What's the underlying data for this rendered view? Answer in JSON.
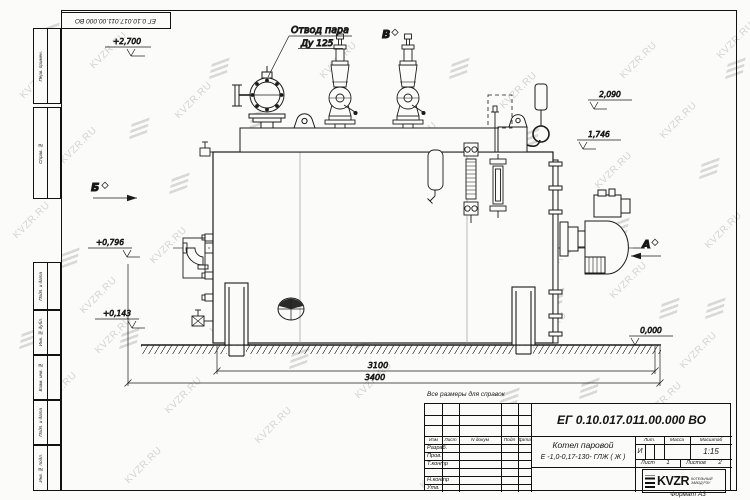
{
  "watermark": {
    "text": "KVZR.RU"
  },
  "frame": {
    "stamp": "ЕГ 0.10.017.011.00.000  ВО",
    "left_cells": [
      "Перв. примен.",
      "Справ. №",
      "Подп. и дата",
      "Инв. № дубл.",
      "Взам. инв. №",
      "Подп. и дата",
      "Инв. № подл."
    ],
    "format_note": "Формат А3"
  },
  "drawing": {
    "callout": {
      "line1": "Отвод пара",
      "line2": "Ду 125"
    },
    "views": {
      "a": "А",
      "b": "Б",
      "v": "В"
    },
    "levels": {
      "top": "+2,700",
      "chimney": "2,090",
      "mid": "1,746",
      "front": "+0,796",
      "low": "+0,143",
      "ground": "0,000"
    },
    "dims": {
      "inner": "3100",
      "overall": "3400"
    }
  },
  "title_block": {
    "reference_note": "Все размеры для справок",
    "doc_number": "ЕГ 0.10.017.011.00.000  ВО",
    "header_cols": [
      "Изм",
      "Лист",
      "N докум",
      "Подп",
      "Дата"
    ],
    "signature_rows": [
      "Разраб.",
      "Пров.",
      "Т.контр",
      "Н.контр",
      "Утв."
    ],
    "product_line1": "Котел паровой",
    "product_line2": "Е -1,0-0,17-130- ГЛЖ ( Ж )",
    "lit_header": "Лит.",
    "mass_header": "Масса",
    "scale_header": "Масштаб",
    "lit_value": "И",
    "scale_value": "1:15",
    "sheet_label": "Лист",
    "sheet_value": "1",
    "sheets_label": "Листов",
    "sheets_value": "2",
    "company": {
      "name": "KVZR",
      "sub1": "КОТЕЛЬНЫЙ",
      "sub2": "ЗАВОД РЭУ"
    }
  }
}
